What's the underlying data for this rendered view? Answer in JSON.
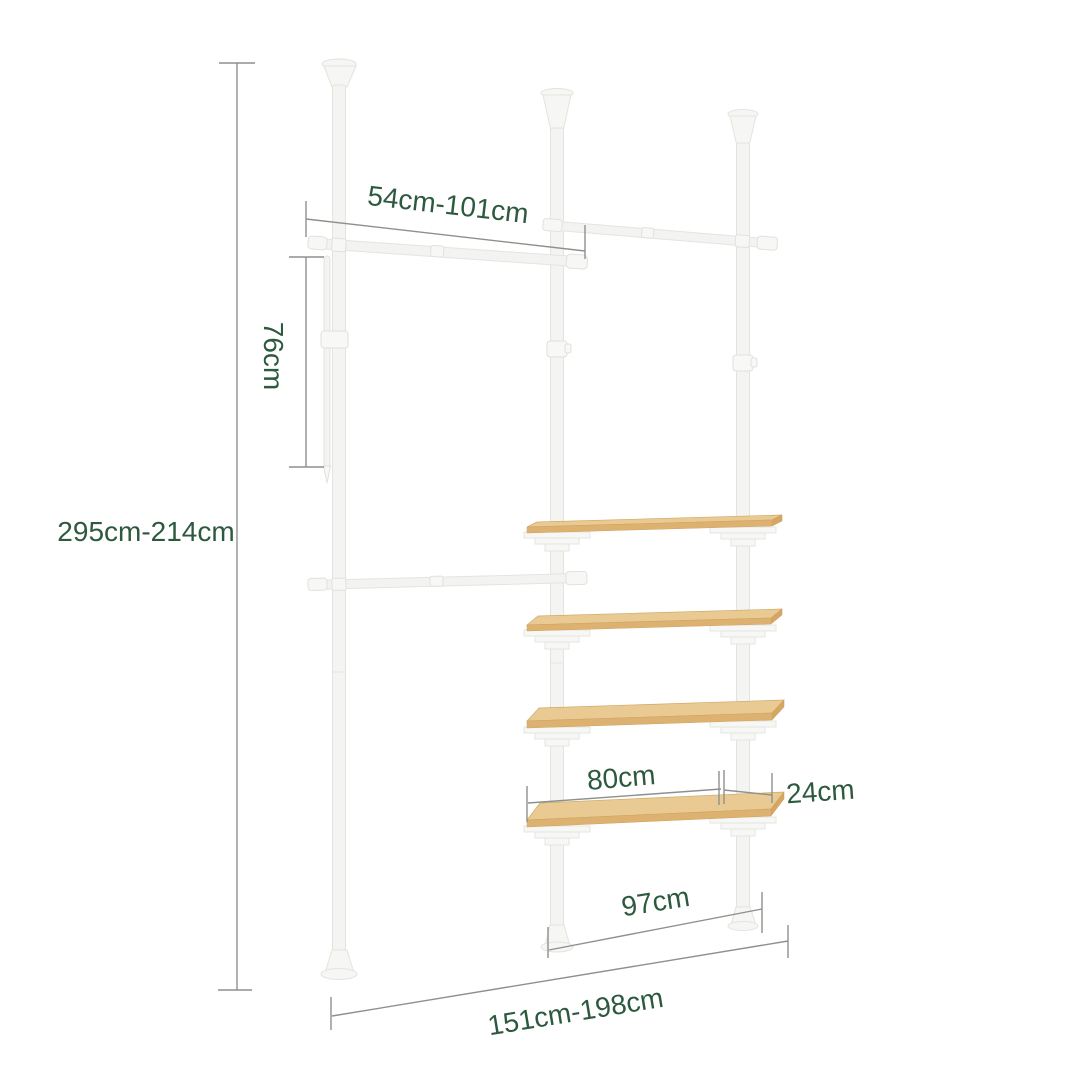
{
  "figure": {
    "kind": "product-dimension-diagram",
    "subject": "telescopic-pole-wardrobe-with-shelves",
    "background": "#ffffff",
    "pole_count": 3,
    "hanging_rail_count": 3,
    "shelf_count": 4
  },
  "colors": {
    "dimension_text": "#2d5a3e",
    "dimension_line": "#8d918d",
    "pole_white": "#f4f5f2",
    "wood_top": "#e9ca92",
    "wood_edge": "#ddb170"
  },
  "dimensions": {
    "overall_height": "295cm-214cm",
    "rail_width": "54cm-101cm",
    "rod_length": "76cm",
    "shelf_width": "80cm",
    "shelf_depth": "24cm",
    "lower_span": "97cm",
    "overall_width": "151cm-198cm"
  }
}
